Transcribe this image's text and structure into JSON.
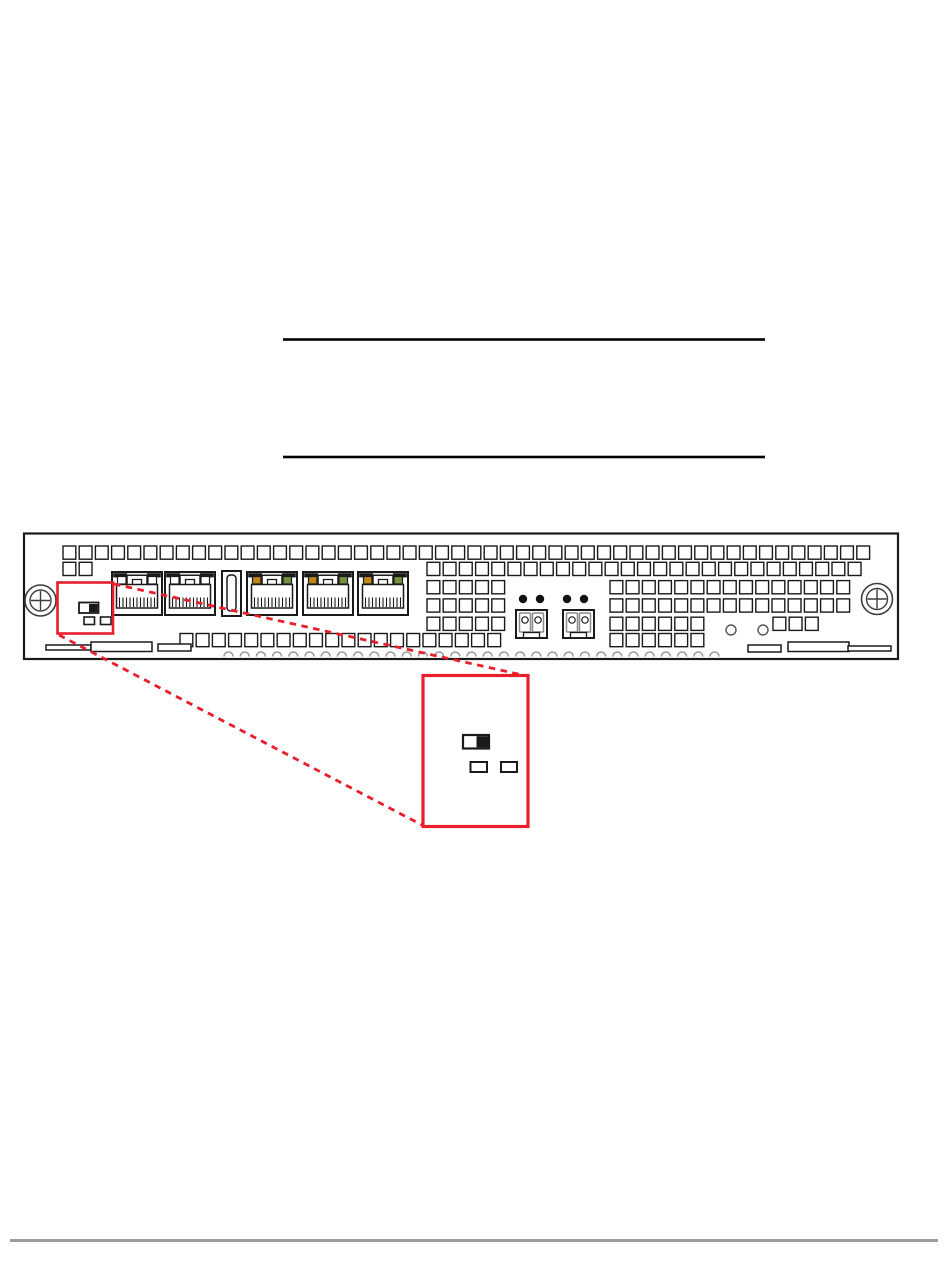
{
  "meta": {
    "description": "Hardware installation guide page: empty two-rule table area, front-panel line drawing of a 1U network appliance module, red highlight box around the mode DIP switch with dotted leader lines to a magnified callout, and a gray footer rule."
  },
  "page": {
    "width": 950,
    "height": 1284,
    "background": "#ffffff",
    "rules": [
      {
        "id": "table-top-rule",
        "x1": 283,
        "x2": 765,
        "y": 339.5,
        "thickness": 2.6,
        "color": "#000000"
      },
      {
        "id": "table-bottom-rule",
        "x1": 283,
        "x2": 765,
        "y": 457.0,
        "thickness": 2.6,
        "color": "#000000"
      },
      {
        "id": "footer-rule",
        "x1": 10,
        "x2": 938,
        "y": 1240.5,
        "thickness": 3.0,
        "color": "#9c9c9c"
      }
    ]
  },
  "figure": {
    "colors": {
      "stroke": "#1a1a1a",
      "highlight": "#e81e2d",
      "led_amber": "#c08519",
      "led_green": "#73913f",
      "plug_gray": "#8a8a8a",
      "arch_gray": "#9a9a9a",
      "screw_gray": "#3d3d3d"
    },
    "panel": {
      "x": 24,
      "y": 533.5,
      "w": 874,
      "h": 125.5
    },
    "screws": [
      {
        "cx": 40.5,
        "cy": 600.5
      },
      {
        "cx": 877,
        "cy": 599
      }
    ],
    "vent": {
      "size": 12.8,
      "pitch": 16.2
    },
    "vent_rows": [
      {
        "y": 546.0,
        "segs": [
          [
            63,
            857
          ]
        ]
      },
      {
        "y": 562.3,
        "segs": [
          [
            63,
            80
          ],
          [
            427,
            857
          ]
        ]
      },
      {
        "y": 580.6,
        "segs": [
          [
            427,
            493
          ],
          [
            610,
            838
          ]
        ]
      },
      {
        "y": 598.9,
        "segs": [
          [
            427,
            493
          ],
          [
            610,
            838
          ]
        ]
      },
      {
        "y": 617.2,
        "segs": [
          [
            427,
            493
          ],
          [
            610,
            692
          ],
          [
            773,
            806
          ]
        ]
      },
      {
        "y": 633.5,
        "segs": [
          [
            180,
            489
          ],
          [
            610,
            692
          ]
        ]
      }
    ],
    "ethernet_ports": {
      "xs": [
        112,
        165,
        247,
        303,
        358
      ],
      "y": 572,
      "w": 50,
      "h": 43,
      "with_leds": [
        2,
        3,
        4
      ]
    },
    "slot": {
      "x": 222,
      "y": 571,
      "w": 19,
      "h": 45,
      "inner_x": 227,
      "inner_y": 575,
      "inner_w": 9,
      "inner_h": 36
    },
    "led_dots": {
      "cxs": [
        523,
        540,
        567,
        584
      ],
      "cy": 599,
      "r": 4.2
    },
    "fiber_ports": {
      "xs": [
        516,
        563
      ],
      "y": 610,
      "w": 31,
      "h": 28
    },
    "small_circles": [
      {
        "cx": 731,
        "cy": 630,
        "r": 5
      },
      {
        "cx": 763,
        "cy": 630,
        "r": 5
      }
    ],
    "handles": {
      "left": [
        [
          46,
          645,
          45,
          5
        ],
        [
          91,
          642,
          61,
          9.5
        ],
        [
          158,
          644,
          33,
          7
        ]
      ],
      "right": [
        [
          748,
          645,
          33,
          7
        ],
        [
          788,
          642,
          61,
          9.5
        ],
        [
          848,
          646,
          43,
          5
        ]
      ]
    },
    "arches": {
      "x_start": 224,
      "count": 31,
      "pitch": 16.2,
      "baseline_y": 656.5,
      "r": 4.5
    },
    "highlight_box": {
      "x": 57.5,
      "y": 582.5,
      "w": 55.5,
      "h": 51
    },
    "panel_switch": {
      "body": [
        79,
        602.5,
        19.5,
        10.5
      ],
      "black_half": [
        89,
        604,
        8.5,
        8
      ],
      "options": [
        [
          84,
          617,
          10.5,
          7.5
        ],
        [
          100.5,
          617,
          10.5,
          7.5
        ]
      ]
    },
    "leader_lines": [
      [
        114,
        584,
        527,
        676
      ],
      [
        59,
        635,
        422,
        825
      ]
    ],
    "callout_box": {
      "x": 423,
      "y": 675.5,
      "w": 105,
      "h": 151
    },
    "callout_switch": {
      "body": [
        463,
        735,
        26,
        13.5
      ],
      "black_half": [
        476.5,
        736.2,
        11.5,
        11.2
      ],
      "options": [
        [
          470.5,
          762,
          16.5,
          10
        ],
        [
          501,
          762,
          16,
          10
        ]
      ]
    }
  }
}
